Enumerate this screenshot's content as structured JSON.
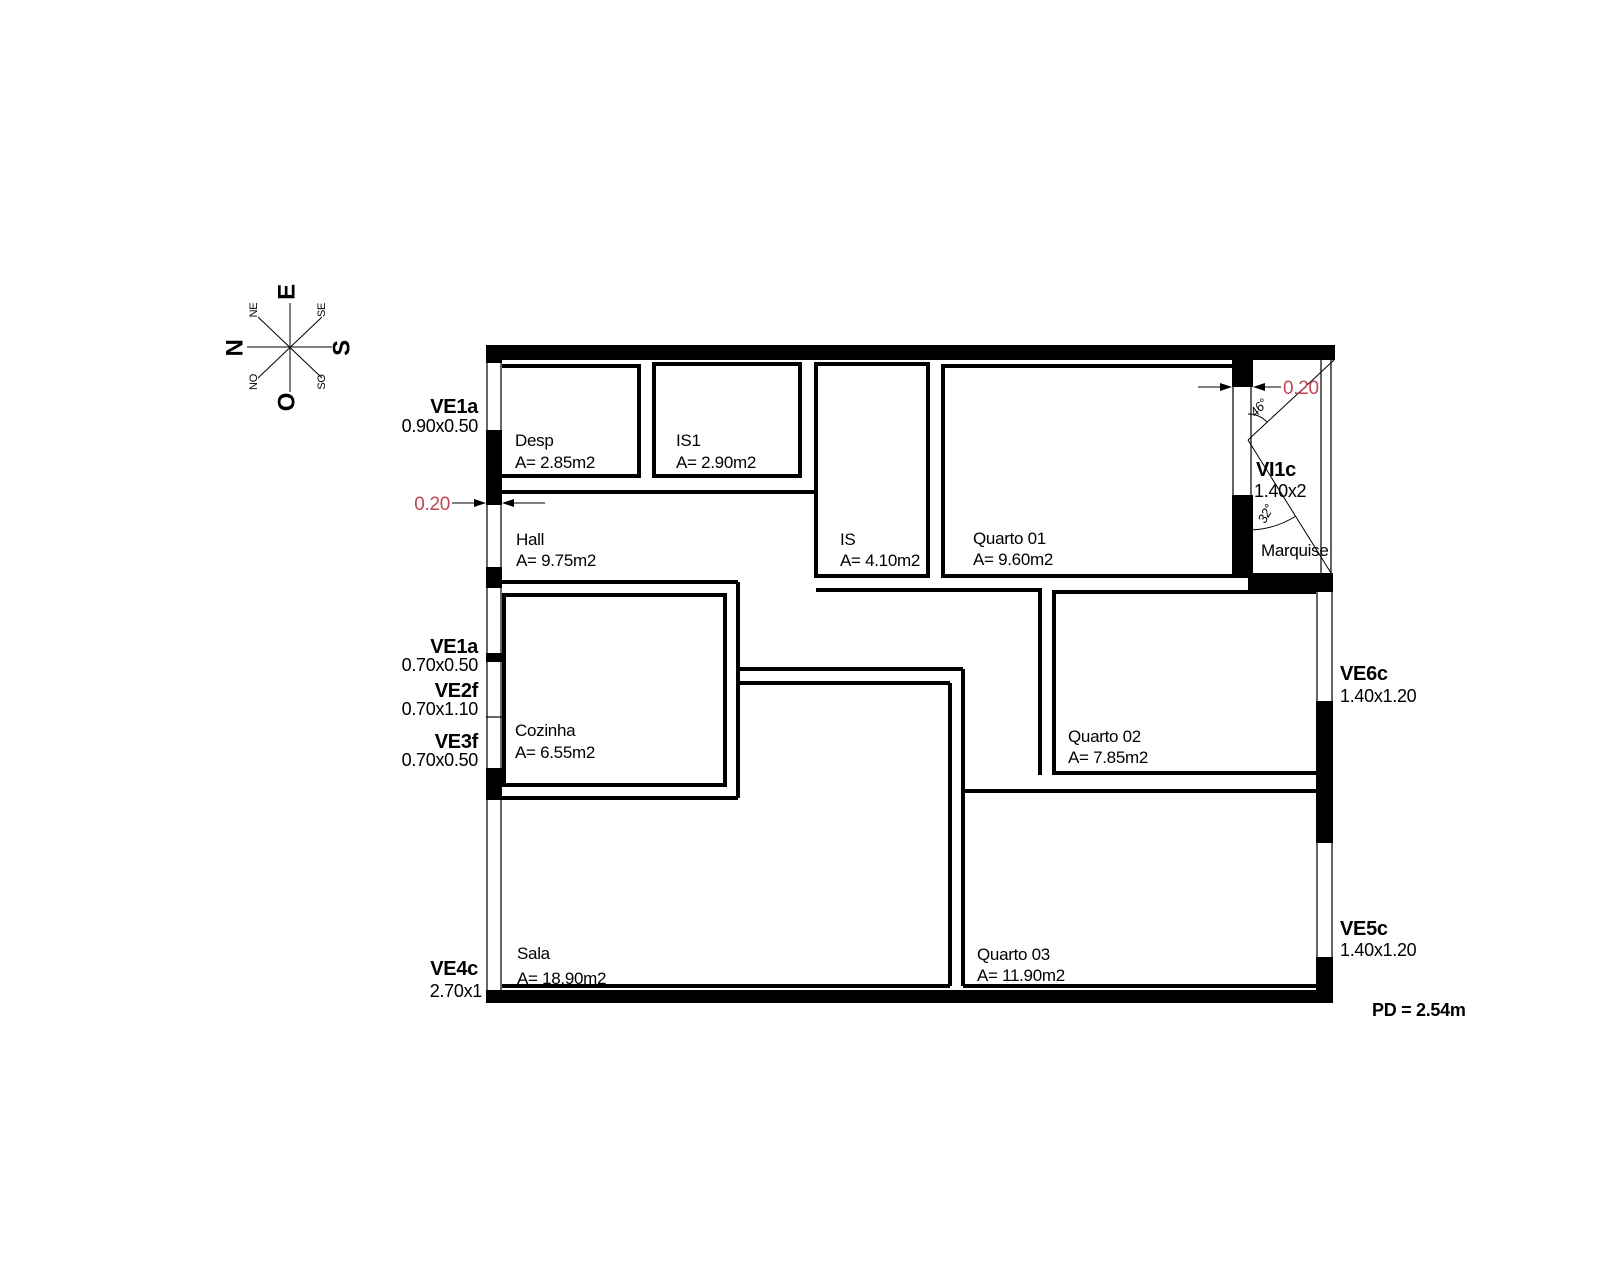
{
  "plan": {
    "rooms": {
      "desp": {
        "name": "Desp",
        "area": "A= 2.85m2"
      },
      "is1": {
        "name": "IS1",
        "area": "A= 2.90m2"
      },
      "is": {
        "name": "IS",
        "area": "A= 4.10m2"
      },
      "quarto01": {
        "name": "Quarto 01",
        "area": "A= 9.60m2"
      },
      "hall": {
        "name": "Hall",
        "area": "A= 9.75m2"
      },
      "cozinha": {
        "name": "Cozinha",
        "area": "A= 6.55m2"
      },
      "quarto02": {
        "name": "Quarto 02",
        "area": "A= 7.85m2"
      },
      "sala": {
        "name": "Sala",
        "area": "A= 18.90m2"
      },
      "quarto03": {
        "name": "Quarto 03",
        "area": "A= 11.90m2"
      },
      "marquise": {
        "name": "Marquise"
      }
    },
    "openings": {
      "ve1a_top": {
        "code": "VE1a",
        "size": "0.90x0.50"
      },
      "ve1a_mid": {
        "code": "VE1a",
        "size": "0.70x0.50"
      },
      "ve2f": {
        "code": "VE2f",
        "size": "0.70x1.10"
      },
      "ve3f": {
        "code": "VE3f",
        "size": "0.70x0.50"
      },
      "ve4c": {
        "code": "VE4c",
        "size": "2.70x1"
      },
      "ve5c": {
        "code": "VE5c",
        "size": "1.40x1.20"
      },
      "ve6c": {
        "code": "VE6c",
        "size": "1.40x1.20"
      },
      "vi1c": {
        "code": "VI1c",
        "size": "1.40x2"
      }
    },
    "dimensions": {
      "wall_thickness_left": "0.20",
      "wall_thickness_right": "0.20",
      "angle_upper": "46°",
      "angle_lower": "32°",
      "ceiling_height": "PD = 2.54m"
    },
    "compass": {
      "e": "E",
      "n": "N",
      "s": "S",
      "o": "O",
      "ne": "NE",
      "se": "SE",
      "no": "NO",
      "so": "SO"
    },
    "colors": {
      "line": "#000000",
      "dimension": "#bf4652"
    }
  }
}
